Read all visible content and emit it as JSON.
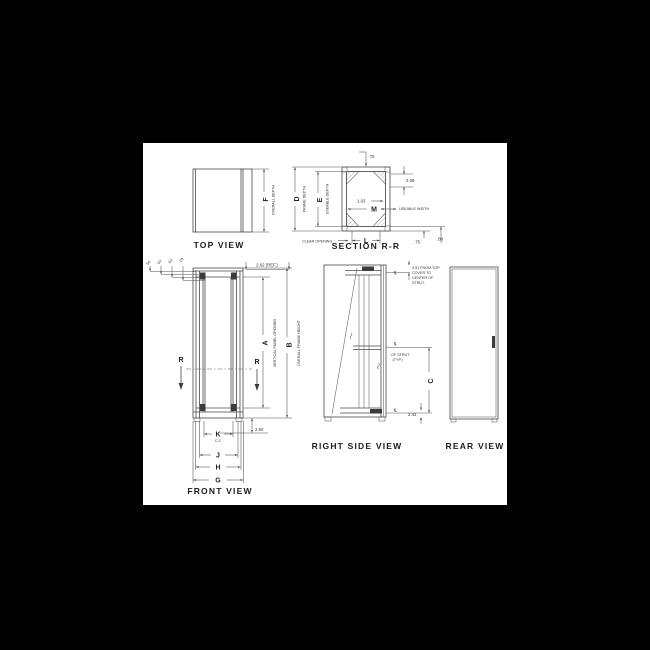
{
  "colors": {
    "background": "#000000",
    "paper": "#ffffff",
    "ink": "#474747"
  },
  "top_view": {
    "title": "TOP VIEW",
    "dim_letter": "F",
    "dim_note": "OVERALL DEPTH"
  },
  "section_view": {
    "title": "SECTION  R-R",
    "dim_d": "D",
    "dim_d_note": "FRAME DEPTH",
    "dim_e": "E",
    "dim_e_note": "USEABLE DEPTH",
    "dim_m": "M",
    "dim_l": "L",
    "useable_width": "USEABLE WIDTH",
    "clear_opening": "CLEAR OPENING",
    "top_thickness": ".75",
    "offset_208": "2.08",
    "offset_103": "1.03",
    "bottom_75": ".75",
    "bottom_88": ".88"
  },
  "front_view": {
    "title": "FRONT VIEW",
    "small_dims": [
      ".50",
      ".63",
      ".62",
      ".28"
    ],
    "ref_dim": "2.62 (REF.)",
    "dim_a": "A",
    "dim_a_note": "VERTICAL PANEL OPENING",
    "dim_b": "B",
    "dim_b_note": "OVERALL FRAME HEIGHT",
    "section_letter": "R",
    "base_height": "2.50",
    "dim_k": "K",
    "dim_k_note": "C-C",
    "dim_j": "J",
    "dim_h": "H",
    "dim_g": "G"
  },
  "right_view": {
    "title": "RIGHT SIDE VIEW",
    "top_note_1": "3.51 FROM TOP",
    "top_note_2": "COVER TO",
    "top_note_3": "CENTER OF",
    "top_note_4": "STRUT.",
    "strut_note_1": "OF STRUT",
    "strut_note_2": "(TYP.)",
    "centerline_symbol": "℄",
    "dim_c": "C",
    "bottom_dim": "2.41"
  },
  "rear_view": {
    "title": "REAR VIEW"
  }
}
